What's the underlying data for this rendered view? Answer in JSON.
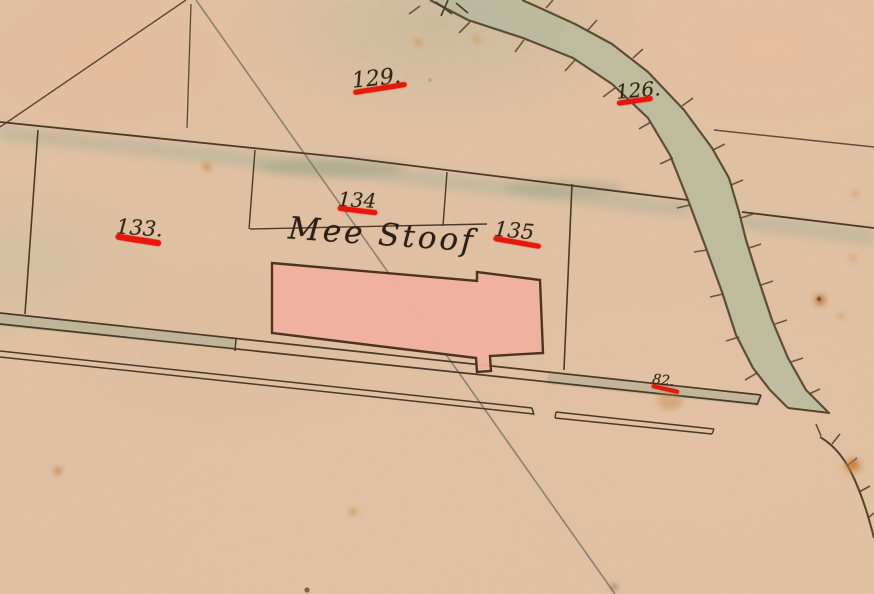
{
  "map": {
    "place_label": "Mee Stoof",
    "parcels": [
      {
        "number": "129."
      },
      {
        "number": "126."
      },
      {
        "number": "133."
      },
      {
        "number": "134"
      },
      {
        "number": "135"
      },
      {
        "number": "82."
      }
    ],
    "colors": {
      "paper": "#e2c2a4",
      "ink": "#4a3a28",
      "red_annotation": "#e8170b",
      "building_fill": "#f1b0a1",
      "water_fill": "#b7ba9e"
    }
  }
}
